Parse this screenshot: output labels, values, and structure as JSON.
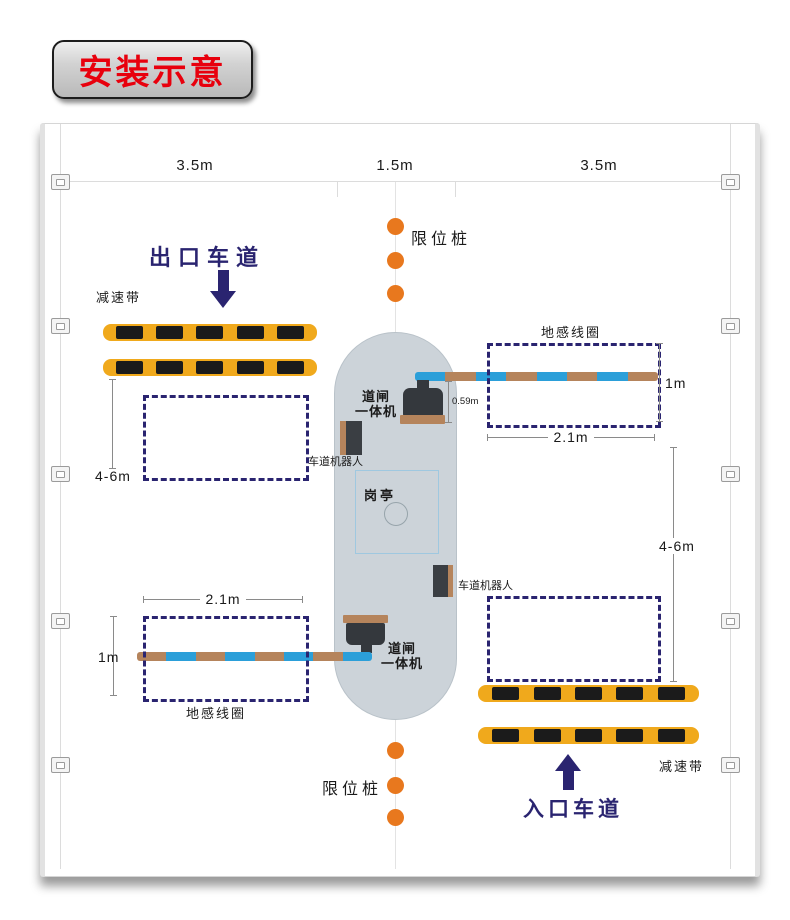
{
  "title": "安装示意",
  "top_dimensions": {
    "left_lane": "3.5m",
    "island": "1.5m",
    "right_lane": "3.5m"
  },
  "lanes": {
    "exit": "出口车道",
    "entrance": "入口车道"
  },
  "components": {
    "limit_post": "限位桩",
    "speed_bump": "减速带",
    "induction_coil": "地感线圈",
    "lane_robot": "车道机器人",
    "barrier_gate": {
      "line1": "道闸",
      "line2": "一体机"
    },
    "guard_booth": "岗亭"
  },
  "measurements": {
    "coil_length": "2.1m",
    "coil_width": "1m",
    "barrier_drop": "0.59m",
    "coil_to_bump": "4-6m"
  },
  "colors": {
    "title_red": "#e8000d",
    "navy": "#2a2470",
    "post_orange": "#e8781e",
    "bump_yellow": "#f0a91c",
    "arm_blue": "#2b9fd9",
    "arm_tan": "#b5845c",
    "island_fill": "#ccd3d9"
  }
}
